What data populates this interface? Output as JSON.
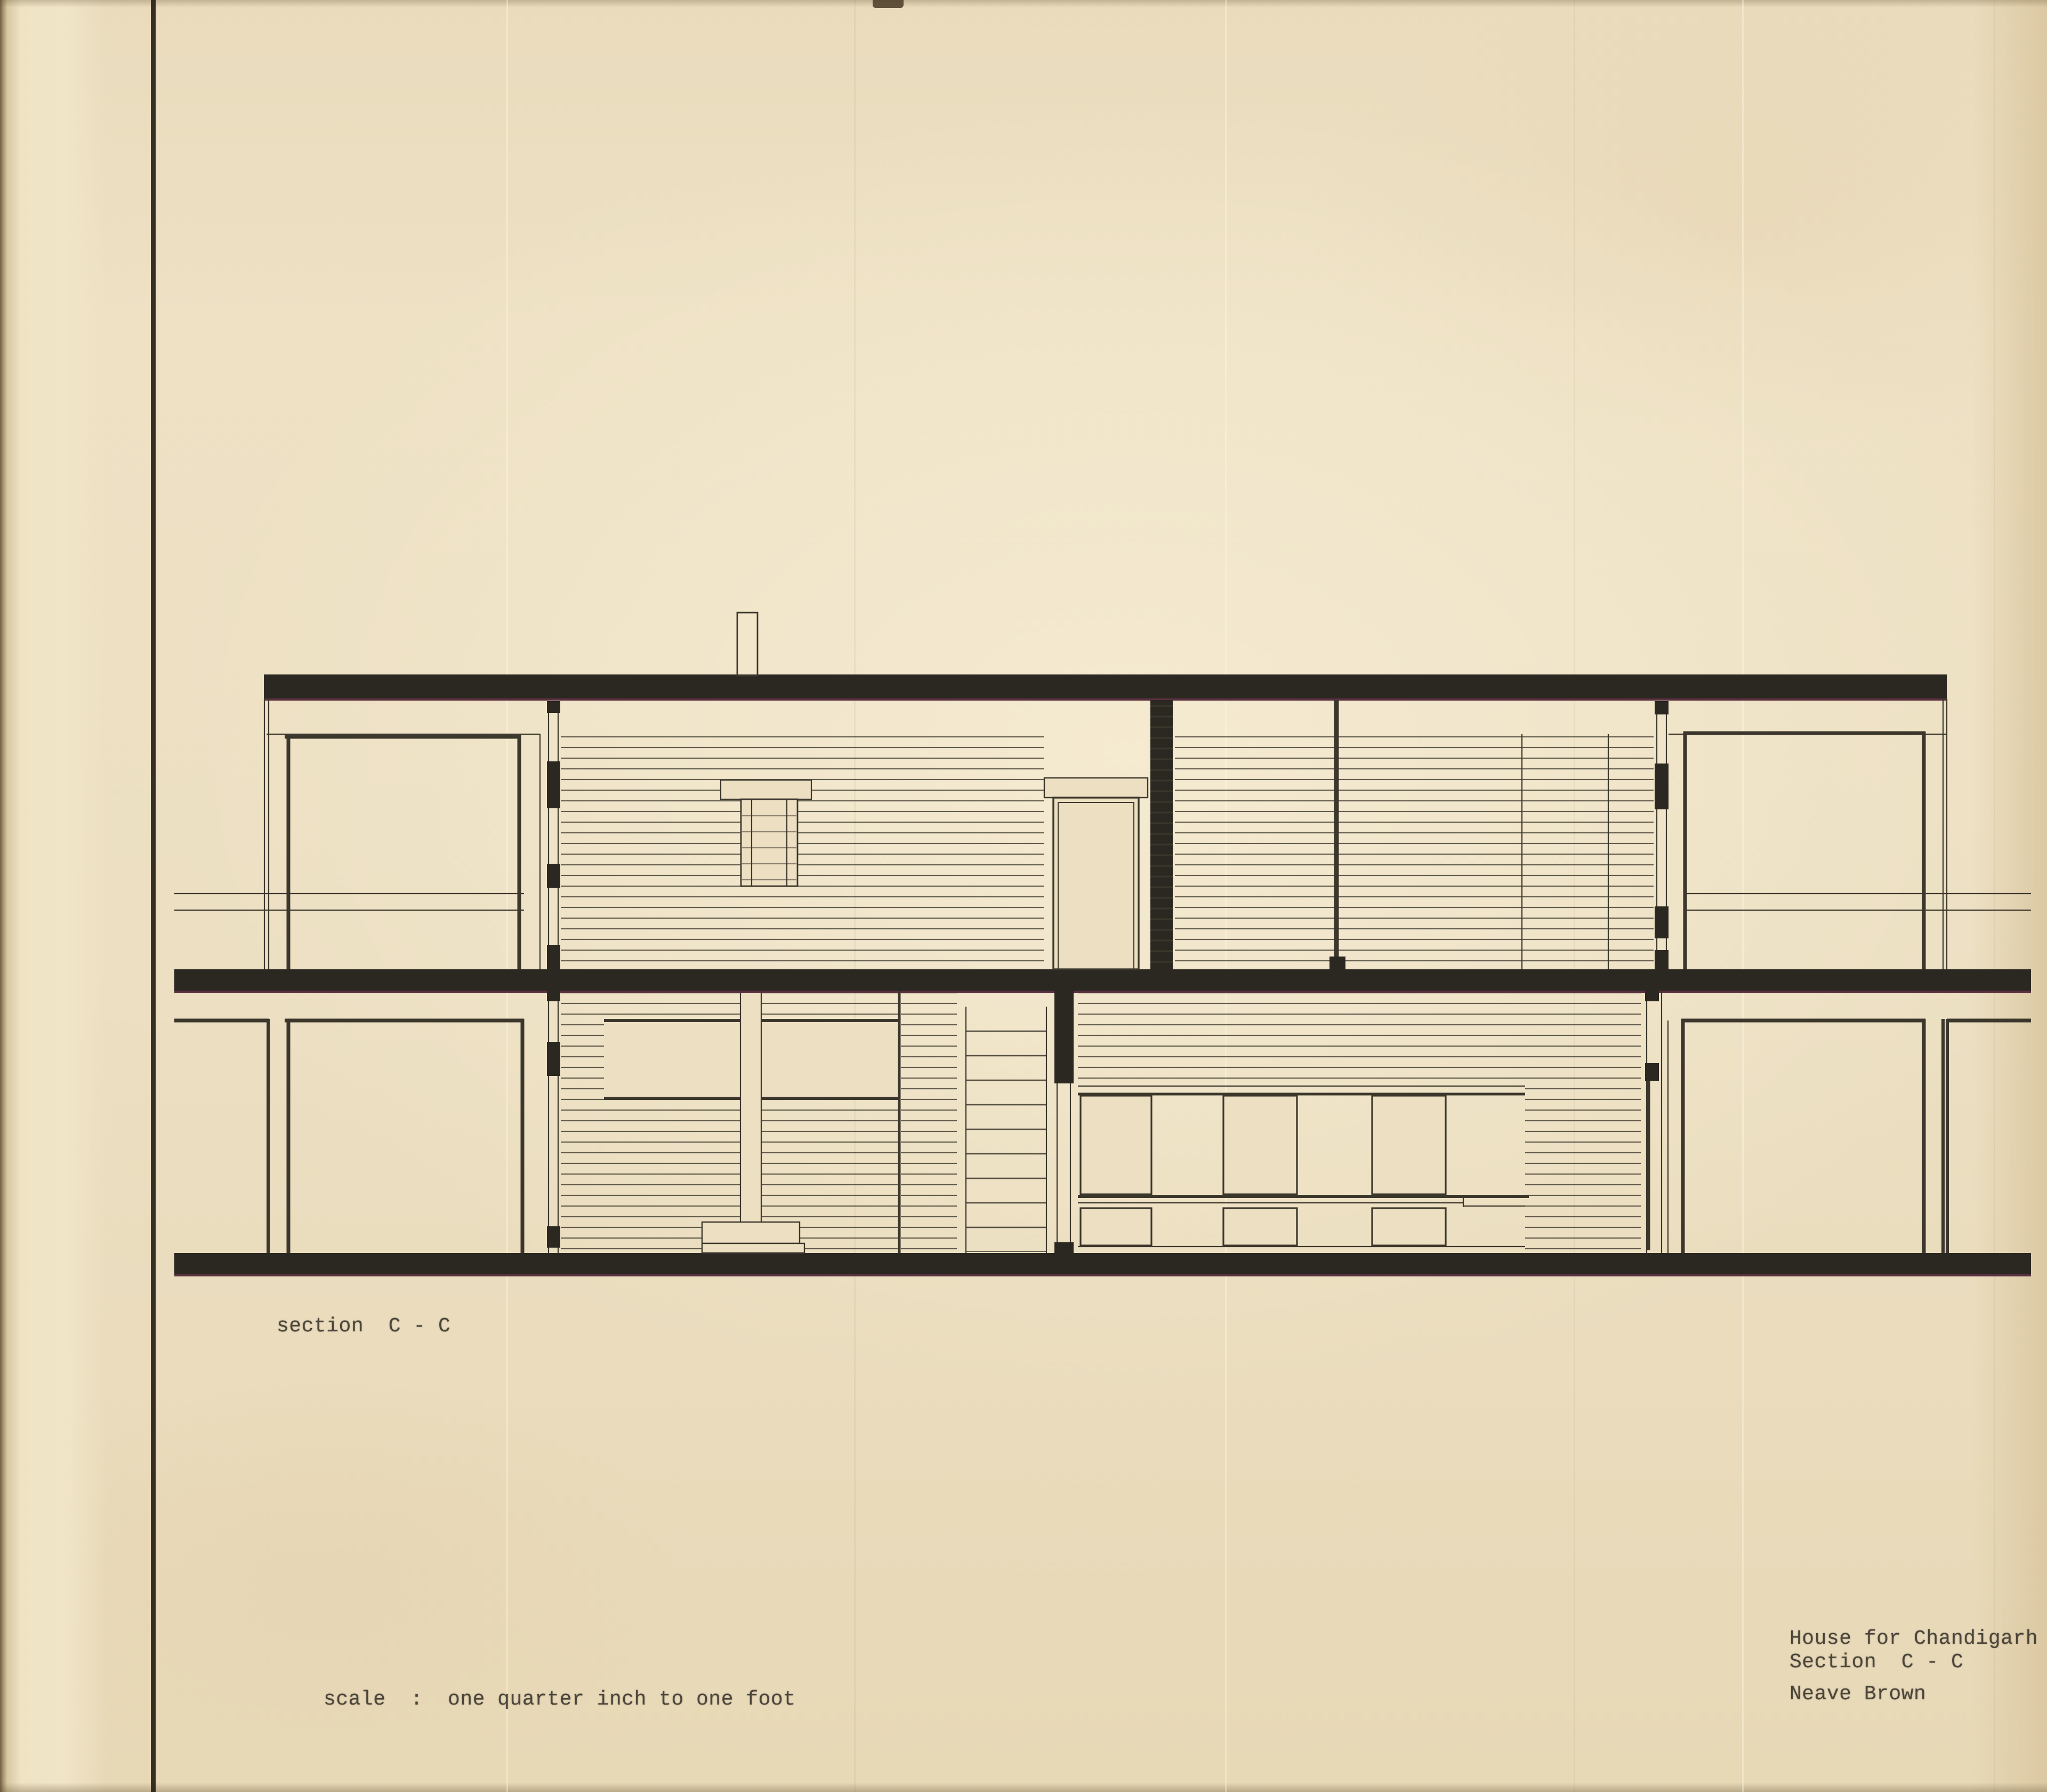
{
  "drawing_titles": {
    "section_label": "section  C - C",
    "scale_note": "scale  :  one quarter inch to one foot",
    "project_title": "House for Chandigarh",
    "sheet_label": "Section  C - C",
    "architect": "Neave Brown"
  },
  "colors": {
    "paper": "#ecdfc2",
    "ink": "#2b2822",
    "line_ink": "#3c372c",
    "slab_underside_fringe": "#5a3040",
    "typewriter_text": "#4b453a",
    "margin_rule": "#261f19"
  }
}
